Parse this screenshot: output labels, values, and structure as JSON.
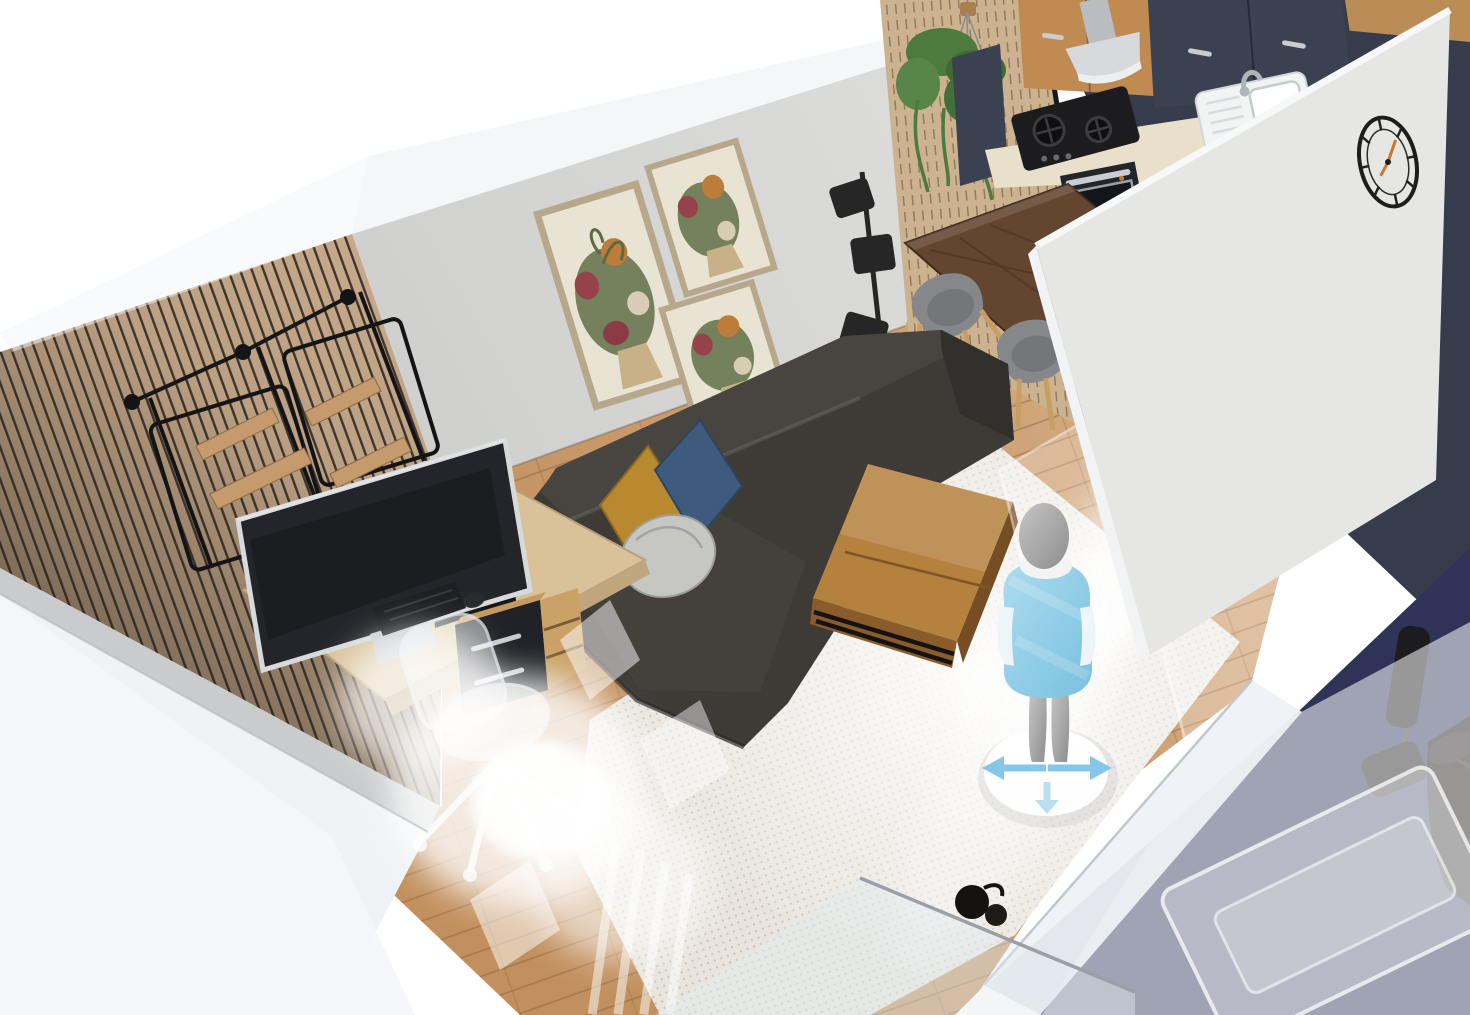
{
  "scene": {
    "view": "cutaway-3d-apartment-viewport",
    "colors": {
      "background": "#ffffff",
      "wall_top": "#f4f6f8",
      "wall_concrete": "#d7d7d5",
      "wall_slat_wood": "#c7aa8b",
      "kitchen_panel_wood": "#cdb28f",
      "wall_navy": "#363c4c",
      "partition_wall": "#e6e6e4",
      "floor_wood": "#cda075",
      "rug_living": "#e9e5dd",
      "rug_kitchen": "#e7ddcb",
      "sofa_base": "#3e3b37",
      "sofa_light": "#484440",
      "sofa_dark": "#32302c",
      "pillow_mustard": "#b8892f",
      "pillow_blue": "#3e5b7e",
      "pillow_silver": "#c6c6c2",
      "coffee_table_top": "#b5813f",
      "coffee_table_side": "#8a5c2c",
      "dining_table": "#64452f",
      "chair_shell": "#85878a",
      "chair_leg_wood": "#c79e63",
      "lamp_black": "#262626",
      "cabinet_wood": "#c08b52",
      "cabinet_dark": "#3a4150",
      "countertop": "#e9e0cc",
      "appliance_black": "#1c1c1e",
      "steel": "#c9ccd0",
      "sink_white": "#f2f4f4",
      "desk_wood": "#d9c29a",
      "monitor_dark": "#23252a",
      "drawer_dark": "#202227",
      "carpet_navy": "#2e3357",
      "leather_black": "#1a1816",
      "avatar_shirt": "#8ccbe7",
      "avatar_body": "#a9a9a9",
      "arrow_blue": "#85c7e8",
      "clock_black": "#1d1d1d",
      "clock_hand": "#c9782e",
      "art_frame": "#b7a78b",
      "art_canvas": "#e9e3d3",
      "ghost_white": "#ffffff"
    },
    "rooms": [
      {
        "name": "living-room",
        "items": [
          "sectional-sofa",
          "throw-pillow-mustard",
          "throw-pillow-blue",
          "throw-pillow-round-silver",
          "coffee-table",
          "area-rug",
          "floor-lamp",
          "wall-art-triptych",
          "slat-accent-wall",
          "hanging-wall-shelves",
          "desk",
          "desktop-monitor",
          "pc-tower",
          "keyboard",
          "mouse",
          "drawer-unit",
          "ghost-office-chair",
          "ghost-plant",
          "floor-fan",
          "glass-panel"
        ]
      },
      {
        "name": "kitchen",
        "items": [
          "upper-cabinets-wood",
          "upper-cabinets-dark",
          "range-hood",
          "gas-cooktop",
          "oven",
          "sink",
          "faucet",
          "base-cabinets-wood",
          "tall-dark-cabinet",
          "countertop",
          "slat-end-panel",
          "hanging-plant",
          "kitchen-rug"
        ]
      },
      {
        "name": "dining-area",
        "items": [
          "dining-table",
          "dining-chair",
          "dining-chair",
          "dining-chair",
          "dining-chair"
        ],
        "chair_count": 4
      },
      {
        "name": "adjacent-room",
        "items": [
          "navy-carpet",
          "speaker-on-stand",
          "leather-sofa",
          "ghost-bed",
          "partition-wall",
          "roman-numeral-wall-clock"
        ]
      }
    ],
    "avatar": {
      "name": "walkthrough-avatar",
      "control_arrows": [
        "left",
        "right",
        "down"
      ]
    }
  }
}
